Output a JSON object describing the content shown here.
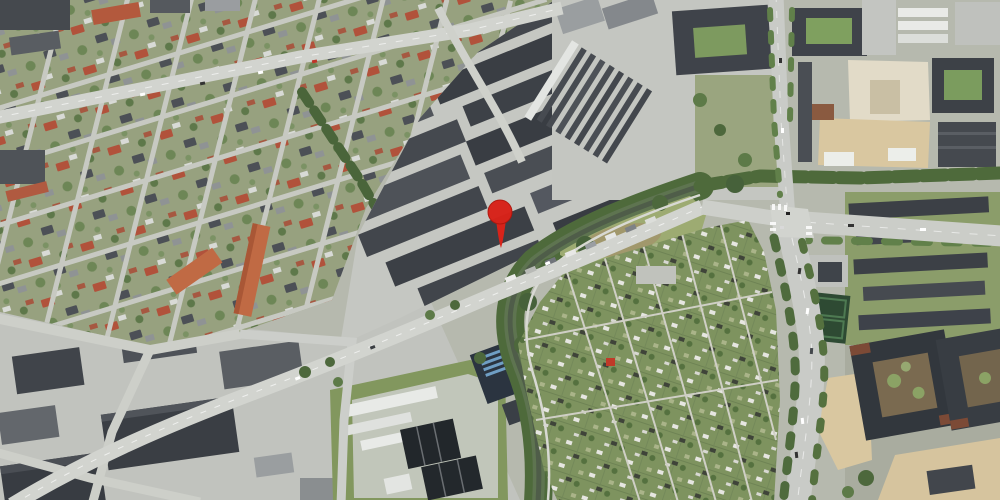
{
  "map": {
    "view_type": "aerial-satellite-photo",
    "regions": [
      "residential-neighborhood",
      "industrial-commercial-area",
      "warehouse-district",
      "stream-green-corridor",
      "meadow",
      "allotment-gardens",
      "water-treatment-plant",
      "construction-site",
      "apartment-blocks",
      "arterial-road",
      "motorway",
      "intersection"
    ],
    "marker": {
      "shape": "map-pin",
      "color": "#d8231a",
      "edge_color": "#a8150c",
      "x": 501,
      "y": 248,
      "transform": "translate(501,248)"
    },
    "palette": {
      "ground": "#b6b9ae",
      "pavement": "#c5c7c2",
      "pavement_sw": "#c1c3be",
      "road": "#d2d4cf",
      "road_major": "#c9cbc7",
      "grass_residential": "#97a17f",
      "grass": "#879b64",
      "tree": "#4d683c",
      "meadow": "#9dab72",
      "brown_field": "#a2946b",
      "water": "#4f5d49",
      "allotment": "#7e935f",
      "dark_roof": "#3d4147",
      "mid_roof": "#565a60",
      "light_roof": "#9fa3a5",
      "white_roof": "#e8eae7",
      "red_roof": "#b1523b",
      "orange_block": "#c06a44",
      "navy_roof": "#2b3440",
      "navy_stripes": "#6f9ec4",
      "sand": "#d9c7a0",
      "construction": "#e2dbc8",
      "basin": "#22272b",
      "courtyard_brown": "#7a6a50"
    }
  }
}
